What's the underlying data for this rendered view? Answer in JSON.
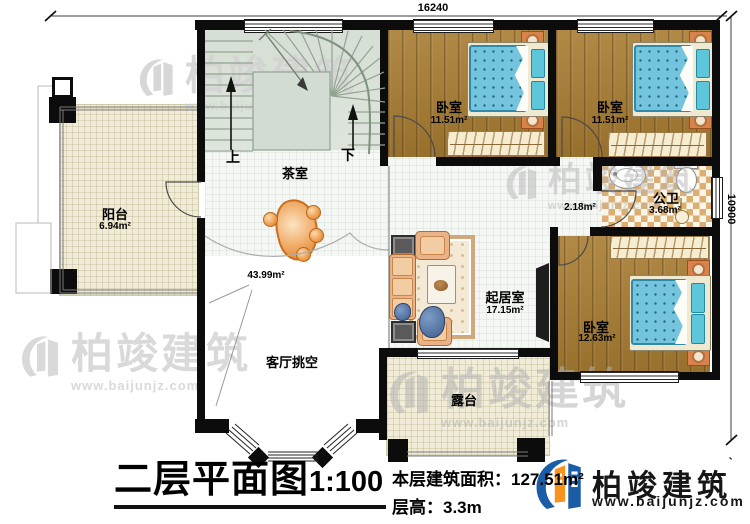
{
  "dimensions": {
    "top": "16240",
    "right": "10900"
  },
  "stairs": {
    "up": "上",
    "down": "下"
  },
  "rooms": {
    "balcony": {
      "name": "阳台",
      "area": "6.94m²"
    },
    "tea_room": {
      "name": "茶室"
    },
    "bedroom1": {
      "name": "卧室",
      "area": "11.51m²"
    },
    "bedroom2": {
      "name": "卧室",
      "area": "11.51m²"
    },
    "bedroom3": {
      "name": "卧室",
      "area": "12.63m²"
    },
    "bathroom": {
      "name": "公卫",
      "area": "3.68m²"
    },
    "hallway": {
      "area": "2.18m²"
    },
    "living_room": {
      "name": "起居室",
      "area": "17.15m²"
    },
    "void": {
      "name": "客厅挑空",
      "area": "43.99m²"
    },
    "terrace": {
      "name": "露台"
    }
  },
  "title_block": {
    "title": "二层平面图",
    "scale": "1:100",
    "floor_area": "本层建筑面积：127.51m²",
    "floor_height": "层高：3.3m"
  },
  "brand": {
    "name": "柏竣建筑",
    "url": "www.baijunjz.com",
    "tick": "ˋ"
  },
  "watermark": {
    "name": "柏竣建筑",
    "url": "www.baijunjz.com"
  }
}
